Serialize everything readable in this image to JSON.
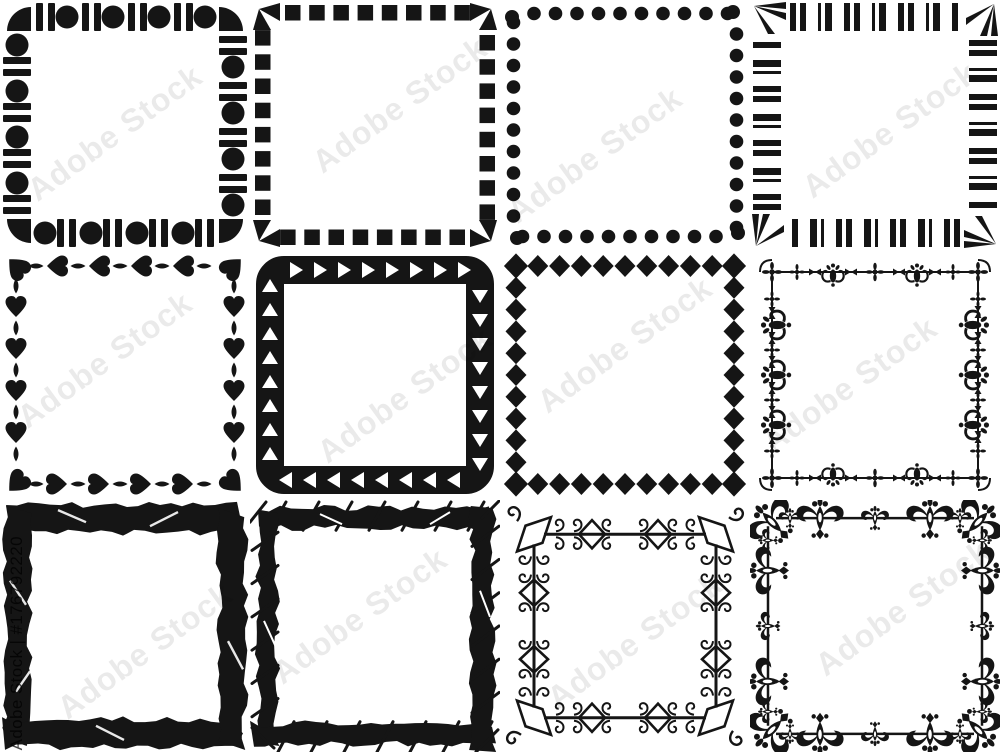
{
  "background": "#ffffff",
  "ink": "#151515",
  "watermark": {
    "diagonal_text": "Adobe Stock",
    "vertical_text": "Adobe Stock | #176792220"
  },
  "frames": [
    {
      "name": "circles-and-bars-frame",
      "type": "circlesBars",
      "description": "square frame made of circles alternating with pairs of vertical bars, quarter-disc corners"
    },
    {
      "name": "dashed-squares-frame",
      "type": "squaresDashed",
      "description": "square frame made of small black squares with angled corner pieces"
    },
    {
      "name": "dotted-frame",
      "type": "dots",
      "description": "square frame made of round black dots"
    },
    {
      "name": "barcode-stripes-frame",
      "type": "stripes",
      "description": "square frame made of barcode-like stripes with ray fans in the corners"
    },
    {
      "name": "hearts-frame",
      "type": "hearts",
      "description": "square frame made of hearts alternating with pointed petals"
    },
    {
      "name": "triangle-band-frame",
      "type": "triangleBand",
      "description": "solid rounded band frame with white triangles pointing around it"
    },
    {
      "name": "diamonds-frame",
      "type": "diamonds",
      "description": "square frame made of diamonds touching tip to tip"
    },
    {
      "name": "delicate-ornament-frame",
      "type": "delicateOrnament",
      "description": "thin ornamental frame with small floral fleur motifs and darts"
    },
    {
      "name": "grunge-marker-frame",
      "type": "grungeThick",
      "description": "thick grunge marker-scribble square frame"
    },
    {
      "name": "grunge-sketch-frame",
      "type": "grungeSketch",
      "description": "sketchy grunge frame with diagonal hatch strokes overshooting the corners"
    },
    {
      "name": "curly-flourish-frame",
      "type": "curlyOrnament",
      "description": "thin flourish frame with diamond cusps and spiral curls"
    },
    {
      "name": "damask-ornament-frame",
      "type": "damask",
      "description": "bold damask floral ornament frame with large tulip motifs"
    }
  ]
}
